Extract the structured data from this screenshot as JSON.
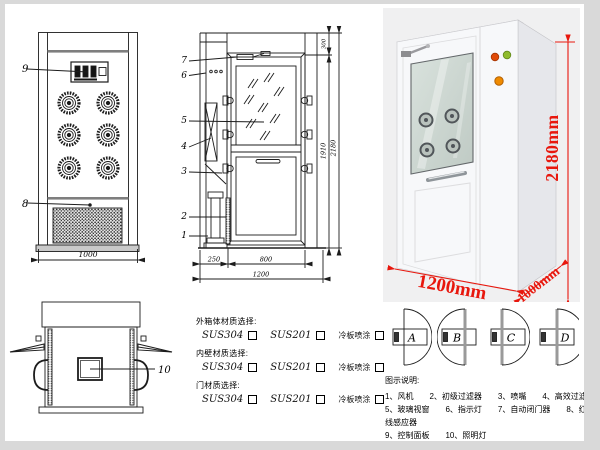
{
  "front_view": {
    "label_9": "9",
    "label_8": "8",
    "dim_width": "1000"
  },
  "side_view": {
    "labels": {
      "l7": "7",
      "l6": "6",
      "l5": "5",
      "l4": "4",
      "l3": "3",
      "l2": "2",
      "l1": "1"
    },
    "dim_top": "300",
    "dim_inner_height": "1910",
    "dim_total_height": "2180",
    "dim_back": "250",
    "dim_door": "800",
    "dim_total_width": "1200"
  },
  "top_view": {
    "label_10": "10"
  },
  "photo": {
    "dim_height": "2180mm",
    "dim_width": "1200mm",
    "dim_depth": "1000mm"
  },
  "materials": {
    "groups": [
      {
        "title": "外箱体材质选择:",
        "opt1": "SUS304",
        "opt2": "SUS201",
        "opt3": "冷板喷涂"
      },
      {
        "title": "内壁材质选择:",
        "opt1": "SUS304",
        "opt2": "SUS201",
        "opt3": "冷板喷涂"
      },
      {
        "title": "门材质选择:",
        "opt1": "SUS304",
        "opt2": "SUS201",
        "opt3": "冷板喷涂"
      }
    ]
  },
  "door_options": {
    "a": "A",
    "b": "B",
    "c": "C",
    "d": "D"
  },
  "legend": {
    "title": "图示说明:",
    "line1": "1、风机　　2、初级过滤器　　3、喷嘴　　4、高效过滤器",
    "line2": "5、玻璃视窗　　6、指示灯　　7、自动闭门器　　8、红外线感应器",
    "line3": "9、控制面板　　10、照明灯"
  },
  "colors": {
    "dimension_red": "#e8170d",
    "line_black": "#1c1c1c",
    "photo_background": "#f0f0f1",
    "frame_gray": "#d9d9d9"
  }
}
